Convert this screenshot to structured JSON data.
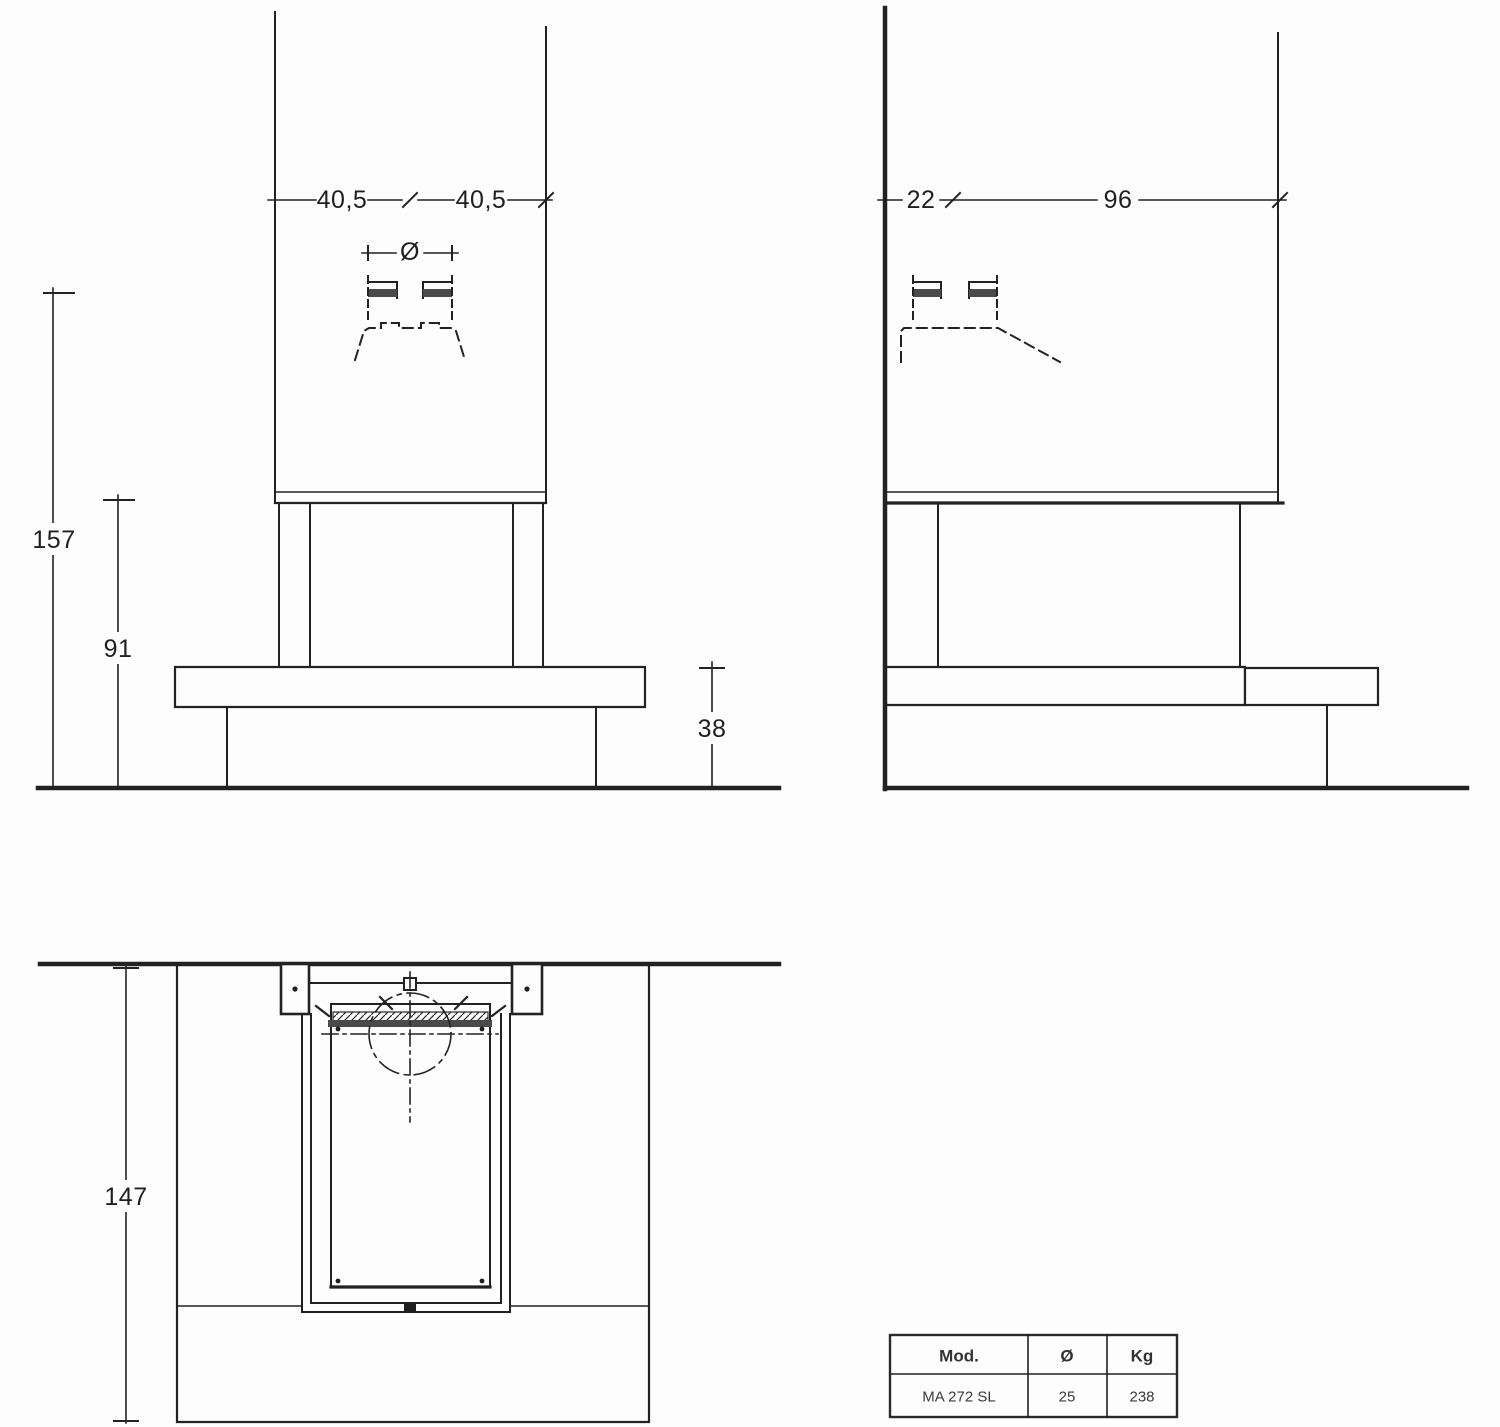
{
  "front_view": {
    "dim_width_left": "40,5",
    "dim_width_right": "40,5",
    "dim_diameter_symbol": "Ø",
    "dim_total_height": "157",
    "dim_hood_height": "91",
    "dim_bench_height": "38"
  },
  "side_view": {
    "dim_wall_gap": "22",
    "dim_depth": "96"
  },
  "plan_view": {
    "dim_depth_total": "147"
  },
  "spec_table": {
    "header": {
      "model": "Mod.",
      "diameter": "Ø",
      "weight": "Kg"
    },
    "row": {
      "model": "MA 272 SL",
      "diameter": "25",
      "weight": "238"
    }
  },
  "colors": {
    "line": "#222222",
    "thick_bar": "#4a4a4a",
    "background": "#fdfdfd"
  }
}
